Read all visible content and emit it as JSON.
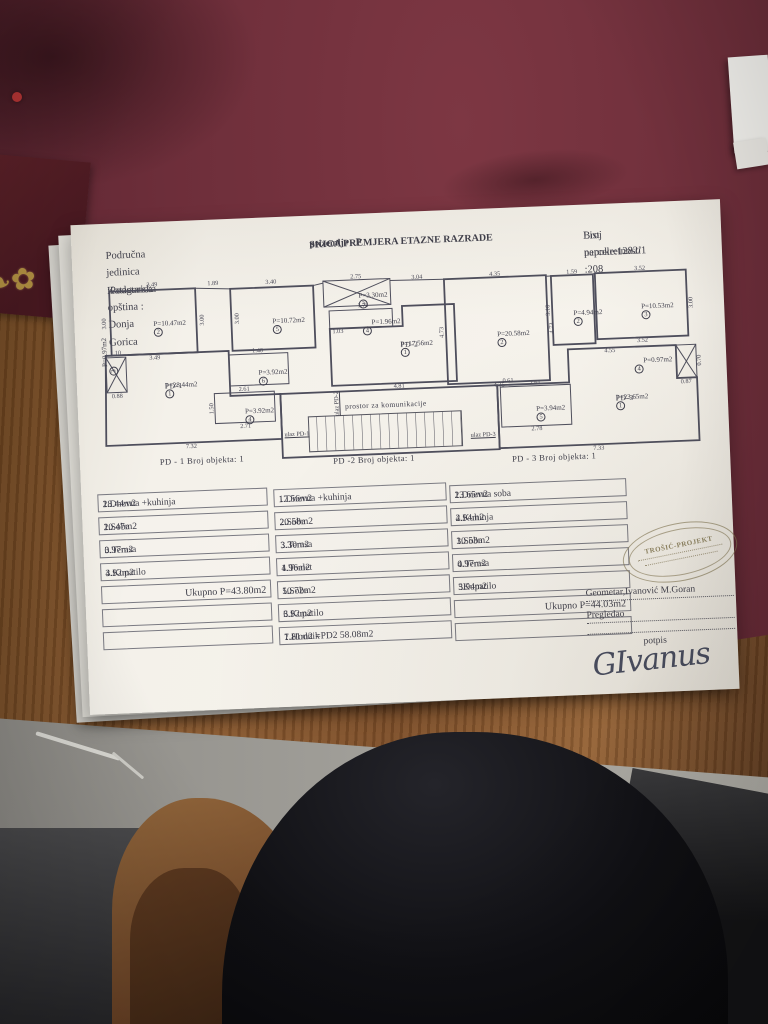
{
  "header": {
    "left_line1": "Područna jedinica :Podgorica",
    "left_line2": "Katastarska opština : Donja Gorica",
    "center_line1": "SKICA PREMJERA ETAZNE RAZRADE",
    "center_line2": "prizemlje - P",
    "right_line1": "List nepokretnosti :208",
    "right_line2": "Broj parcele:1282/1"
  },
  "plan": {
    "corridor": {
      "t": "prostor za komunikacije",
      "x": 286,
      "y": 130
    },
    "entrances": [
      {
        "t": "ulaz PD-1",
        "x": 196,
        "y": 156,
        "r": 0
      },
      {
        "t": "ulaz PD-2",
        "x": 237,
        "y": 127,
        "r": -90
      },
      {
        "t": "ulaz PD-3",
        "x": 382,
        "y": 164,
        "r": 0
      }
    ],
    "captions": [
      {
        "text": "PD - 1   Broj objekta: 1",
        "x": 100,
        "y": 178
      },
      {
        "text": "PD -2   Broj objekta: 1",
        "x": 272,
        "y": 184
      },
      {
        "text": "PD - 3   Broj objekta: 1",
        "x": 452,
        "y": 189
      }
    ],
    "rooms": [
      {
        "circle": "2",
        "area": "P=10.47m2",
        "x": 57,
        "y": 36
      },
      {
        "circle": "5",
        "area": "P=10.72m2",
        "x": 176,
        "y": 38
      },
      {
        "circle": "3",
        "area": "P=3.30m2",
        "x": 263,
        "y": 16
      },
      {
        "circle": "4",
        "area": "P=1.96m2",
        "x": 266,
        "y": 43,
        "inline": 1
      },
      {
        "circle": "6",
        "area": "P=3.92m2",
        "x": 160,
        "y": 89
      },
      {
        "circle": "4",
        "area": "P=3.92m2",
        "x": 145,
        "y": 127
      },
      {
        "pd": "PD-1",
        "circle": "1",
        "area": "P=28.44m2",
        "x": 66,
        "y": 98
      },
      {
        "pd": "PD-2",
        "circle": "1",
        "area": "P=17.56m2",
        "x": 303,
        "y": 66
      },
      {
        "circle": "2",
        "area": "P=20.58m2",
        "x": 400,
        "y": 60
      },
      {
        "circle": "2",
        "area": "P=4.94m2",
        "x": 477,
        "y": 42
      },
      {
        "circle": "3",
        "area": "P=10.53m2",
        "x": 545,
        "y": 38
      },
      {
        "circle": "4",
        "area": "P=0.97m2",
        "x": 536,
        "y": 92,
        "inline": 1
      },
      {
        "pd": "PD-3",
        "circle": "1",
        "area": "P=23.65m2",
        "x": 516,
        "y": 128
      },
      {
        "circle": "5",
        "area": "P=3.94m2",
        "x": 436,
        "y": 136
      },
      {
        "circle": "3",
        "area": "P=0.97m2",
        "x": 3,
        "y": 90,
        "r": -90,
        "inline": 1
      }
    ],
    "dims": [
      {
        "t": "3.49",
        "x": 57,
        "y": 1
      },
      {
        "t": "3.00",
        "x": 8,
        "y": 38,
        "r": -90
      },
      {
        "t": "3.49",
        "x": 57,
        "y": 74
      },
      {
        "t": "3.00",
        "x": 106,
        "y": 38,
        "r": -90
      },
      {
        "t": "1.89",
        "x": 118,
        "y": 2
      },
      {
        "t": "3.40",
        "x": 176,
        "y": 3
      },
      {
        "t": "3.00",
        "x": 141,
        "y": 38,
        "r": -90
      },
      {
        "t": "2.75",
        "x": 261,
        "y": 1
      },
      {
        "t": "1.75",
        "x": 267,
        "y": 30
      },
      {
        "t": "3.04",
        "x": 322,
        "y": 4
      },
      {
        "t": "1.03",
        "x": 241,
        "y": 55
      },
      {
        "t": "1.40",
        "x": 160,
        "y": 71
      },
      {
        "t": "1.50",
        "x": 112,
        "y": 127,
        "r": -90
      },
      {
        "t": "2.61",
        "x": 145,
        "y": 109
      },
      {
        "t": "2.71",
        "x": 145,
        "y": 146
      },
      {
        "t": "4.35",
        "x": 400,
        "y": 4
      },
      {
        "t": "4.73",
        "x": 345,
        "y": 60,
        "r": -90
      },
      {
        "t": "4.73",
        "x": 455,
        "y": 60,
        "r": -90
      },
      {
        "t": "4.35",
        "x": 400,
        "y": 115
      },
      {
        "t": "1.59",
        "x": 477,
        "y": 5
      },
      {
        "t": "3.10",
        "x": 452,
        "y": 42,
        "r": -90
      },
      {
        "t": "3.52",
        "x": 545,
        "y": 4
      },
      {
        "t": "3.00",
        "x": 595,
        "y": 40,
        "r": -90
      },
      {
        "t": "3.52",
        "x": 545,
        "y": 76
      },
      {
        "t": "4.55",
        "x": 512,
        "y": 85
      },
      {
        "t": "0.70",
        "x": 601,
        "y": 98,
        "r": -90
      },
      {
        "t": "0.87",
        "x": 587,
        "y": 119
      },
      {
        "t": "7.32",
        "x": 90,
        "y": 164
      },
      {
        "t": "7.33",
        "x": 497,
        "y": 182
      },
      {
        "t": "4.81",
        "x": 300,
        "y": 112
      },
      {
        "t": "2.61",
        "x": 436,
        "y": 114
      },
      {
        "t": "2.78",
        "x": 436,
        "y": 160
      },
      {
        "t": "1.10",
        "x": 18,
        "y": 68
      },
      {
        "t": "0.88",
        "x": 18,
        "y": 111
      },
      {
        "t": "0.61",
        "x": 409,
        "y": 111
      }
    ]
  },
  "tables": [
    {
      "rows": [
        {
          "label": "1.Dnevna +kuhinja",
          "value": "28.44m2"
        },
        {
          "label": "2.Soba",
          "value": "10.47m2"
        },
        {
          "label": "3.Terasa",
          "value": "0.97m2"
        },
        {
          "label": "4.Kupatilo",
          "value": "3.92m2"
        }
      ],
      "total": "Ukupno  P=43.80m2",
      "empty_rows": 2
    },
    {
      "rows": [
        {
          "label": "1.Dnevna +kuhinja",
          "value": "17.56m2"
        },
        {
          "label": "2.Soba",
          "value": "20.58m2"
        },
        {
          "label": "3.Terasa",
          "value": "3.30m2"
        },
        {
          "label": "4.Toalet",
          "value": "1.96m2"
        },
        {
          "label": "5.Soba",
          "value": "10.72m2"
        },
        {
          "label": "6.Kupatilo",
          "value": "3.92m2"
        },
        {
          "label": "7.Hodnik",
          "value": "1.81m2  =PD2  58.08m2"
        }
      ],
      "total": null,
      "empty_rows": 0
    },
    {
      "rows": [
        {
          "label": "1.Dnevna soba",
          "value": "23.65m2"
        },
        {
          "label": "2.Kuhinja",
          "value": "4.94m2"
        },
        {
          "label": "3.Soba",
          "value": "10.53m2"
        },
        {
          "label": "4.Terasa",
          "value": "0.97m2"
        },
        {
          "label": "5Kupatilo",
          "value": "3.94m2"
        }
      ],
      "total": "Ukupno  P=44.03m2",
      "empty_rows": 1
    }
  ],
  "signature_block": {
    "stamp_text": "TROŠIĆ-PROJEKT",
    "geometar": "Geometar,Ivanović M.Goran",
    "pregledao": "Pregledao",
    "potpis": "potpis",
    "signature": "GIvanus"
  }
}
